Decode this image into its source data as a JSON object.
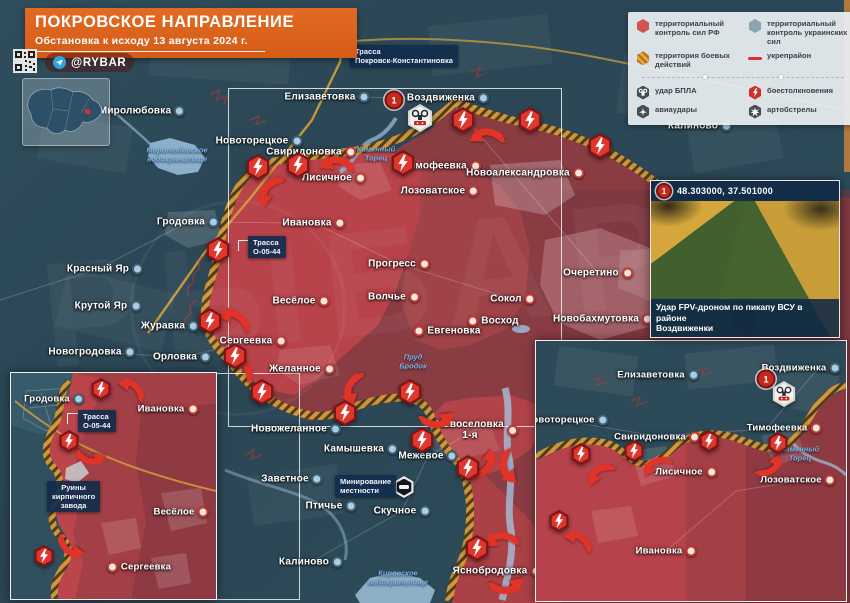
{
  "header": {
    "title": "ПОКРОВСКОЕ НАПРАВЛЕНИЕ",
    "subtitle": "Обстановка к исходу 13 августа 2024 г.",
    "channel": "@RYBAR"
  },
  "road_callout": "Трасса\nПокровск-Константиновка",
  "legend_items": [
    {
      "icon": "hex-rf",
      "label": "территориальный контроль сил РФ"
    },
    {
      "icon": "hex-ua",
      "label": "территориальный контроль украинских сил"
    },
    {
      "icon": "hex-combat",
      "label": "территория боевых действий"
    },
    {
      "icon": "line-fort",
      "label": "укрепрайон"
    },
    {
      "icon": "hex-uav",
      "label": "удар БПЛА"
    },
    {
      "icon": "hex-clash",
      "label": "боестолкновения"
    },
    {
      "icon": "hex-air",
      "label": "авиаудары"
    },
    {
      "icon": "hex-arty",
      "label": "артобстрелы"
    }
  ],
  "main_map": {
    "towns": [
      {
        "name": "Миролюбовка"
      },
      {
        "name": "Елизаветовка"
      },
      {
        "name": "Воздвиженка"
      },
      {
        "name": "Калиново"
      },
      {
        "name": "Новоторецкое"
      },
      {
        "name": "Свиридоновка"
      },
      {
        "name": "Тимофеевка"
      },
      {
        "name": "Новоалександровка"
      },
      {
        "name": "Лисичное"
      },
      {
        "name": "Лозоватское"
      },
      {
        "name": "Гродовка"
      },
      {
        "name": "Ивановка"
      },
      {
        "name": "Прогресс"
      },
      {
        "name": "Очеретино"
      },
      {
        "name": "Красный Яр"
      },
      {
        "name": "Крутой Яр"
      },
      {
        "name": "Весёлое"
      },
      {
        "name": "Волчье"
      },
      {
        "name": "Сокол"
      },
      {
        "name": "Восход"
      },
      {
        "name": "Журавка"
      },
      {
        "name": "Евгеновка"
      },
      {
        "name": "Новобахмутовка"
      },
      {
        "name": "Новогродовка"
      },
      {
        "name": "Орловка"
      },
      {
        "name": "Сергеевка"
      },
      {
        "name": "Желанное"
      },
      {
        "name": "Новожеланное"
      },
      {
        "name": "Камышевка"
      },
      {
        "name": "Новоселовка\n1-я"
      },
      {
        "name": "Заветное"
      },
      {
        "name": "Межевое"
      },
      {
        "name": "Птичье"
      },
      {
        "name": "Скучное"
      },
      {
        "name": "Калиново"
      },
      {
        "name": "Яснобродовка"
      }
    ],
    "water_labels": [
      {
        "text": "Миролюбовское\nводохранилище"
      },
      {
        "text": "Каменный\nТорец"
      },
      {
        "text": "Пруд\nБродок"
      },
      {
        "text": "Кировское\nводохранилище"
      }
    ],
    "callouts": [
      {
        "text": "Трасса\nО-05-44"
      },
      {
        "text": "Минирование\nместности"
      }
    ],
    "photo_marker": "1"
  },
  "photo_inset": {
    "marker": "1",
    "coordinates": "48.303000, 37.501000",
    "caption": "Удар FPV-дроном по пикапу ВСУ в районе\nВоздвиженки"
  },
  "inset_left": {
    "towns": [
      {
        "name": "Гродовка"
      },
      {
        "name": "Ивановка"
      },
      {
        "name": "Весёлое"
      },
      {
        "name": "Сергеевка"
      }
    ],
    "callouts": [
      {
        "text": "Трасса\nО-05-44"
      },
      {
        "text": "Руины\nкирпичного\nзавода"
      }
    ]
  },
  "inset_right": {
    "towns": [
      {
        "name": "Елизаветовка"
      },
      {
        "name": "Воздвиженка"
      },
      {
        "name": "Новоторецкое"
      },
      {
        "name": "Свиридоновка"
      },
      {
        "name": "Тимофеевка"
      },
      {
        "name": "Лисичное"
      },
      {
        "name": "Лозоватское"
      },
      {
        "name": "Ивановка"
      }
    ],
    "water": "Каменный\nТорец",
    "marker": "1"
  },
  "watermark": "РЫБАРЬ",
  "colors": {
    "rf_control": "#a33f46",
    "rf_advance": "#b8434b",
    "ua_control": "#2d4a59",
    "combat_line": "#d79a36",
    "clash_icon": "#df372e",
    "accent_orange": "#d55c17",
    "callout_bg": "#112d4d"
  }
}
